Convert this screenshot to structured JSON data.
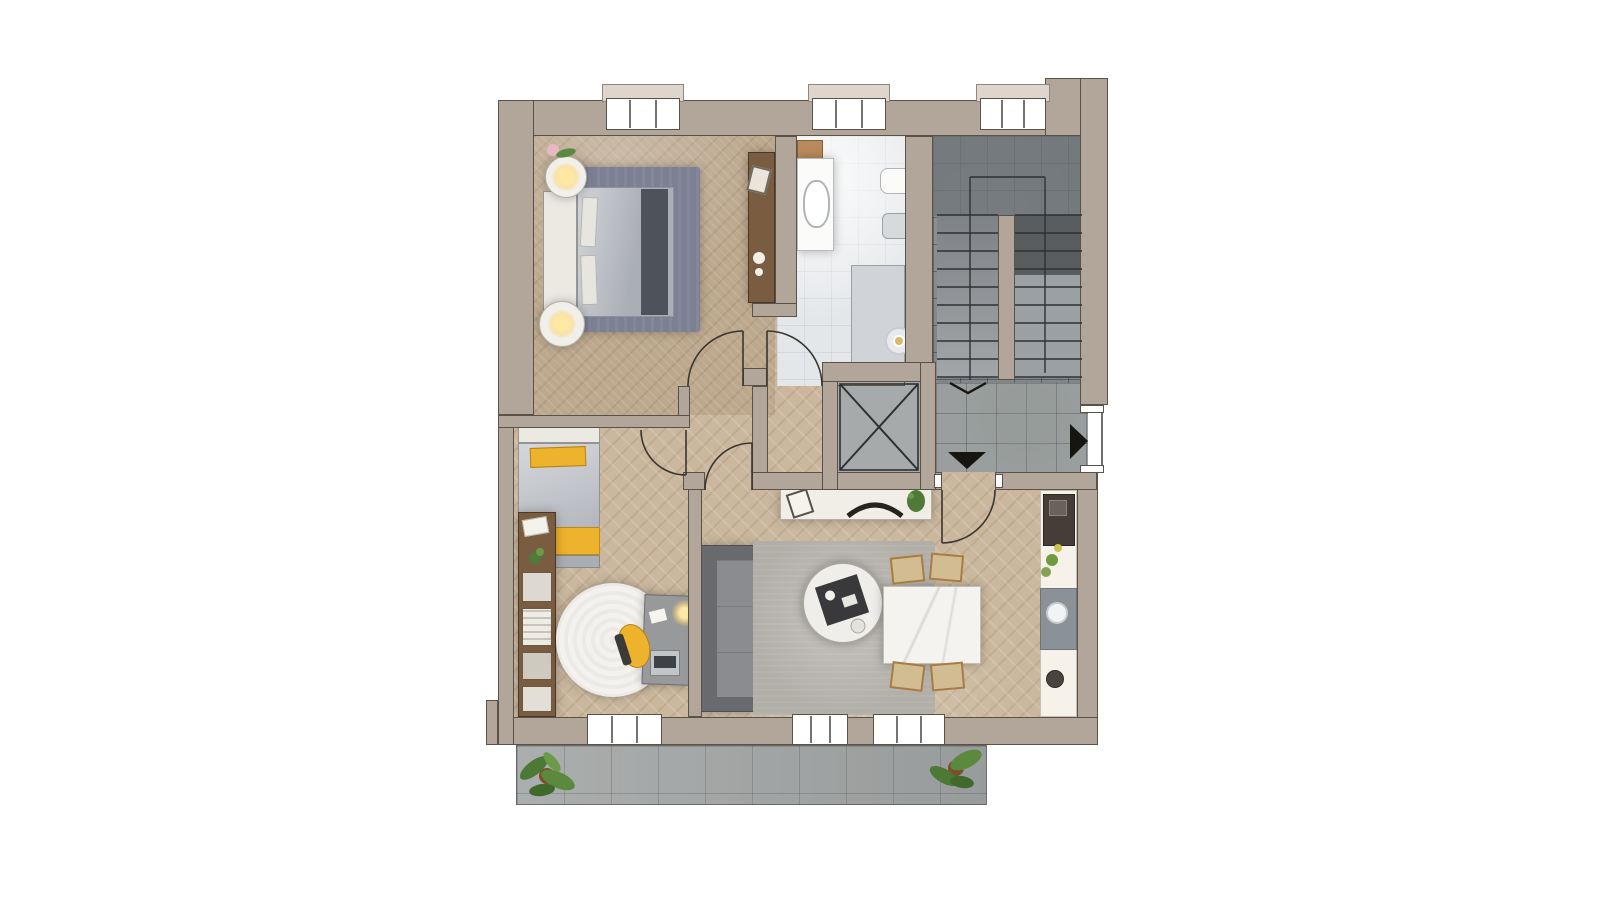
{
  "meta": {
    "type": "architectural-floor-plan",
    "view": "top-down-3d-render",
    "canvas": {
      "width": 1600,
      "height": 900
    },
    "background": "#ffffff",
    "visible_text": ""
  },
  "palette": {
    "wall": "#b2a69a",
    "wallLine": "#5a5248",
    "wood": "#cab79d",
    "tile": "#e4e7ea",
    "shower": "#d0d4d9",
    "stair": "#82868a",
    "stairDark": "#6f7478",
    "stairDarker": "#595d60",
    "landing": "#9a9e9f",
    "elevator": "#a7aaab",
    "terrace": "#a2a5a5",
    "rugBlue": "#7b8093",
    "rugWhite": "#f3f2ee",
    "rugGrey": "#b2afa9",
    "bedGrey": "#b9bdc4",
    "headboard": "#ece9e3",
    "runner": "#4e525a",
    "yellow": "#eeb32c",
    "sofa": "#8b8c8f",
    "sofaDark": "#696a6d",
    "white": "#f1eee7",
    "marble": "#f4f3f0",
    "woodFurn": "#7a5c41",
    "chairWood": "#a87c42",
    "chairSeat": "#d2bd92",
    "counter": "#f6f2e9",
    "steel": "#8a9197",
    "stove": "#453e38",
    "plant": "#4f7a38",
    "ink": "#3a352e",
    "sill": "#ded6cc"
  },
  "rooms": [
    {
      "id": "master-bedroom",
      "floor": "herringbone-wood"
    },
    {
      "id": "bathroom",
      "floor": "light-grey-tile"
    },
    {
      "id": "stairwell",
      "floor": "dark-grey-tile"
    },
    {
      "id": "elevator-shaft",
      "floor": "grey-tile-cross"
    },
    {
      "id": "landing-hall",
      "floor": "grey-tile"
    },
    {
      "id": "inner-hallway",
      "floor": "herringbone-wood"
    },
    {
      "id": "second-bedroom",
      "floor": "herringbone-wood"
    },
    {
      "id": "living-dining-room",
      "floor": "herringbone-wood"
    },
    {
      "id": "kitchen-strip",
      "floor": "herringbone-wood"
    },
    {
      "id": "terrace",
      "floor": "grey-pavers"
    }
  ],
  "furniture": {
    "master_bedroom": [
      "double-bed",
      "white-headboard",
      "dark-bed-runner",
      "blue-grey-rug",
      "round-nightstand-with-lamp-top",
      "round-nightstand-with-lamp-bottom",
      "wood-sideboard",
      "flower-decor"
    ],
    "bathroom": [
      "vanity-with-sink",
      "wood-shelf",
      "wall-hung-toilet",
      "bidet",
      "shower-area",
      "round-floor-lamp"
    ],
    "second_bedroom": [
      "single-bed-yellow-blanket",
      "yellow-pillow",
      "wall-shelf-unit",
      "round-white-rug",
      "desk",
      "yellow-desk-chair",
      "desk-lamp",
      "typewriter"
    ],
    "living_dining": [
      "tv-console",
      "tv",
      "picture-frame",
      "plant-pot",
      "grey-sofa",
      "grey-rug",
      "round-coffee-table",
      "serving-tray",
      "marble-dining-table",
      "dining-chair-1",
      "dining-chair-2",
      "dining-chair-3",
      "dining-chair-4"
    ],
    "kitchen": [
      "counter",
      "cooktop",
      "sink-module",
      "round-sink",
      "kettle",
      "greens"
    ],
    "stairwell": [
      "stair-flight-left",
      "stair-flight-right",
      "spine-wall",
      "direction-chevron"
    ],
    "terrace": [
      "plant-left",
      "plant-right"
    ]
  },
  "openings": {
    "doors": [
      "master-bedroom-door",
      "bathroom-door",
      "second-bedroom-door",
      "living-room-door",
      "apartment-entry-door"
    ],
    "windows_top": 3,
    "windows_bottom": 3,
    "markers": [
      "landing-down-arrow",
      "entry-right-arrow",
      "stair-direction-chevron"
    ]
  }
}
